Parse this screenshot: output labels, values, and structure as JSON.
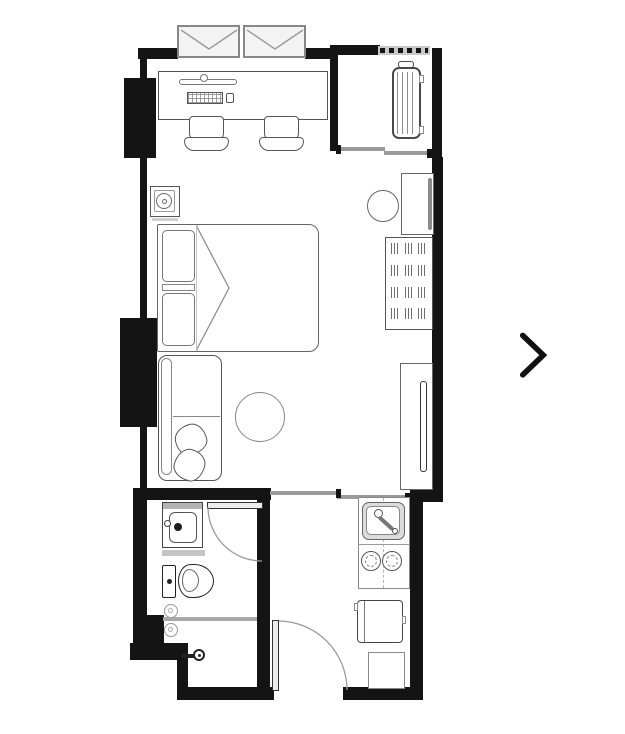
{
  "page": {
    "type": "floor-plan-photo-viewer"
  },
  "theme": {
    "wall": "#141414",
    "line": "#555555",
    "line_dark": "#2a2a2a",
    "line_soft": "#8a8a8a",
    "glass": "#9a9a9a",
    "fixture": "#c4c4c4",
    "arrow": "#111111",
    "bg": "#ffffff",
    "paper": "#ffffff"
  },
  "carousel": {
    "next_icon": "chevron-right-icon",
    "arrow_color": "#111111"
  },
  "floorplan": {
    "rooms": [
      "sleeping-living-area",
      "ac-ledge-balcony",
      "bathroom",
      "kitchen-entry-hall"
    ],
    "furniture": [
      "casement-window",
      "casement-window",
      "work-desk",
      "monitor-shelf",
      "keyboard",
      "mouse",
      "desk-chair",
      "desk-chair",
      "nightstand-lamp",
      "double-bed",
      "pillow",
      "pillow",
      "duvet-fold",
      "ac-outdoor-unit",
      "sliding-window",
      "dressing-table",
      "wall-mirror",
      "stool",
      "wardrobe-hanging-rail",
      "tv-console",
      "wall-tv",
      "sofa",
      "throw-cushion",
      "throw-cushion",
      "round-rug",
      "washbasin",
      "bathroom-door",
      "toilet",
      "floor-drain",
      "floor-drain",
      "shower-glass-partition",
      "shower-mixer",
      "sliding-door",
      "kitchen-sink",
      "two-burner-stove",
      "refrigerator",
      "base-cabinet",
      "entry-door",
      "ventilation-grille"
    ]
  }
}
